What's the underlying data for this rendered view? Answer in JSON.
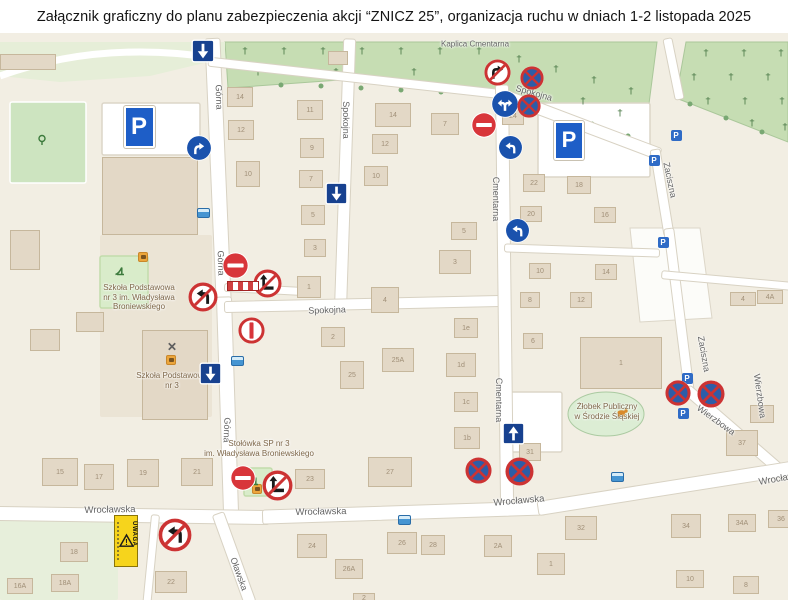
{
  "title": "Załącznik graficzny do planu zabezpieczenia akcji “ZNICZ 25”, organizacja ruchu w dniach 1-2 listopada 2025",
  "colors": {
    "sign_blue": "#1a52ad",
    "oneway_blue": "#17418f",
    "prohibit_red": "#cc3333",
    "no_entry_red": "#d8353a",
    "no_stop_blue": "#2d5da8",
    "parking_blue": "#1e5ec7",
    "uwaga_yellow": "#f6d41c",
    "bus_blue": "#4695d2",
    "cemetery_green": "#c6ddb3",
    "building_tan": "#e3d8c6"
  },
  "map": {
    "street_labels": [
      [
        "Kaplica Cmentarna",
        475,
        44,
        0,
        8
      ],
      [
        "Górna",
        219,
        97,
        88,
        9
      ],
      [
        "Górna",
        221,
        263,
        88,
        9
      ],
      [
        "Górna",
        227,
        430,
        92,
        9
      ],
      [
        "Spokojna",
        346,
        120,
        90,
        9
      ],
      [
        "Spokojna",
        327,
        310,
        -2,
        9
      ],
      [
        "Spokojna",
        534,
        93,
        16,
        9
      ],
      [
        "Cmentarna",
        496,
        199,
        90,
        9
      ],
      [
        "Cmentarna",
        499,
        400,
        90,
        9
      ],
      [
        "Zaciszna",
        670,
        180,
        78,
        9
      ],
      [
        "Zaciszna",
        704,
        354,
        80,
        9
      ],
      [
        "Wierzbowa",
        760,
        396,
        82,
        9
      ],
      [
        "Wierzbowa",
        716,
        420,
        36,
        9
      ],
      [
        "Wrocławska",
        110,
        510,
        -1,
        9.5
      ],
      [
        "Wrocławska",
        321,
        512,
        -1,
        9.5
      ],
      [
        "Wrocławska",
        519,
        501,
        -5,
        9.5
      ],
      [
        "Wrocławska",
        784,
        478,
        -10,
        9.5
      ],
      [
        "Oławska",
        239,
        574,
        70,
        9
      ]
    ],
    "poi_labels": [
      {
        "x": 139,
        "y": 283,
        "lines": [
          "Szkoła Podstawowa",
          "nr 3 im. Władysława",
          "Broniewskiego"
        ]
      },
      {
        "x": 172,
        "y": 371,
        "lines": [
          "Szkoła Podstawowa",
          "nr 3"
        ]
      },
      {
        "x": 259,
        "y": 439,
        "lines": [
          "Stołówka SP nr 3",
          "im. Władysława Broniewskiego"
        ]
      },
      {
        "x": 607,
        "y": 402,
        "lines": [
          "Żłobek Publiczny",
          "w Środzie Śląskiej"
        ]
      }
    ],
    "buildings": [
      [
        240,
        97,
        26,
        20,
        "14"
      ],
      [
        241,
        130,
        26,
        20,
        "12"
      ],
      [
        248,
        174,
        24,
        26,
        "10"
      ],
      [
        310,
        110,
        26,
        20,
        "11"
      ],
      [
        312,
        148,
        24,
        20,
        "9"
      ],
      [
        311,
        179,
        24,
        18,
        "7"
      ],
      [
        313,
        215,
        24,
        20,
        "5"
      ],
      [
        315,
        248,
        22,
        18,
        "3"
      ],
      [
        309,
        287,
        24,
        22,
        "1"
      ],
      [
        393,
        115,
        36,
        24,
        "14"
      ],
      [
        385,
        144,
        26,
        20,
        "12"
      ],
      [
        376,
        176,
        24,
        20,
        "10"
      ],
      [
        445,
        124,
        28,
        22,
        "7"
      ],
      [
        464,
        231,
        26,
        18,
        "5"
      ],
      [
        455,
        262,
        32,
        24,
        "3"
      ],
      [
        385,
        300,
        28,
        26,
        "4"
      ],
      [
        333,
        337,
        24,
        20,
        "2"
      ],
      [
        398,
        360,
        32,
        24,
        "25A"
      ],
      [
        352,
        375,
        24,
        28,
        "25"
      ],
      [
        466,
        328,
        24,
        20,
        "1e"
      ],
      [
        461,
        365,
        30,
        24,
        "1d"
      ],
      [
        466,
        402,
        24,
        20,
        "1c"
      ],
      [
        467,
        438,
        26,
        22,
        "1b"
      ],
      [
        513,
        116,
        22,
        18,
        "24"
      ],
      [
        534,
        183,
        22,
        18,
        "22"
      ],
      [
        579,
        185,
        24,
        18,
        "18"
      ],
      [
        531,
        214,
        22,
        16,
        "20"
      ],
      [
        605,
        215,
        22,
        16,
        "16"
      ],
      [
        540,
        271,
        22,
        16,
        "10"
      ],
      [
        606,
        272,
        22,
        16,
        "14"
      ],
      [
        581,
        300,
        22,
        16,
        "12"
      ],
      [
        530,
        300,
        20,
        16,
        "8"
      ],
      [
        533,
        341,
        20,
        16,
        "6"
      ],
      [
        743,
        299,
        26,
        14,
        "4"
      ],
      [
        770,
        297,
        26,
        14,
        "4A"
      ],
      [
        762,
        414,
        24,
        18,
        "7"
      ],
      [
        742,
        443,
        32,
        26,
        "37"
      ],
      [
        530,
        452,
        22,
        18,
        "31"
      ],
      [
        621,
        363,
        82,
        52,
        "1"
      ],
      [
        60,
        472,
        36,
        28,
        "15"
      ],
      [
        99,
        477,
        30,
        26,
        "17"
      ],
      [
        143,
        473,
        32,
        28,
        "19"
      ],
      [
        197,
        472,
        32,
        28,
        "21"
      ],
      [
        74,
        552,
        28,
        20,
        "18"
      ],
      [
        65,
        583,
        28,
        18,
        "18A"
      ],
      [
        20,
        586,
        26,
        16,
        "16A"
      ],
      [
        171,
        582,
        32,
        22,
        "22"
      ],
      [
        310,
        479,
        30,
        20,
        "23"
      ],
      [
        390,
        472,
        44,
        30,
        "27"
      ],
      [
        312,
        546,
        30,
        24,
        "24"
      ],
      [
        349,
        569,
        28,
        20,
        "26A"
      ],
      [
        402,
        543,
        30,
        22,
        "26"
      ],
      [
        433,
        545,
        24,
        20,
        "28"
      ],
      [
        498,
        546,
        28,
        22,
        "2A"
      ],
      [
        581,
        528,
        32,
        24,
        "32"
      ],
      [
        686,
        526,
        30,
        24,
        "34"
      ],
      [
        742,
        523,
        28,
        18,
        "34A"
      ],
      [
        781,
        519,
        26,
        18,
        "36"
      ],
      [
        551,
        564,
        28,
        22,
        "1"
      ],
      [
        690,
        579,
        28,
        18,
        "10"
      ],
      [
        746,
        585,
        26,
        18,
        "8"
      ],
      [
        364,
        598,
        22,
        10,
        "2"
      ],
      [
        150,
        196,
        96,
        78,
        ""
      ],
      [
        175,
        375,
        66,
        90,
        ""
      ],
      [
        28,
        62,
        56,
        16,
        ""
      ],
      [
        338,
        58,
        20,
        14,
        ""
      ],
      [
        90,
        322,
        28,
        20,
        ""
      ],
      [
        45,
        340,
        30,
        22,
        ""
      ],
      [
        25,
        250,
        30,
        40,
        ""
      ]
    ],
    "signs": [
      [
        "oneway-down",
        203,
        51,
        24,
        24
      ],
      [
        "oneway-down",
        336,
        193,
        23,
        23
      ],
      [
        "oneway-down",
        210,
        373,
        23,
        23
      ],
      [
        "oneway-up",
        513,
        433,
        23,
        23
      ],
      [
        "mandatory-right",
        199,
        148,
        26,
        26
      ],
      [
        "mandatory-left-right",
        505,
        104,
        28,
        28
      ],
      [
        "mandatory-left",
        510,
        147,
        25,
        25
      ],
      [
        "mandatory-left",
        517,
        230,
        25,
        25
      ],
      [
        "no-entry",
        484,
        125,
        26,
        26
      ],
      [
        "no-entry",
        235,
        265,
        27,
        27
      ],
      [
        "no-entry",
        243,
        478,
        26,
        26
      ],
      [
        "no-stopping",
        532,
        78,
        24,
        24
      ],
      [
        "no-stopping",
        529,
        106,
        24,
        24
      ],
      [
        "no-stopping",
        478,
        470,
        27,
        27
      ],
      [
        "no-stopping",
        519,
        471,
        29,
        29
      ],
      [
        "no-stopping",
        678,
        393,
        26,
        26
      ],
      [
        "no-stopping",
        711,
        394,
        28,
        28
      ],
      [
        "no-right-turn",
        497,
        72,
        27,
        27
      ],
      [
        "no-left-turn",
        203,
        297,
        30,
        30
      ],
      [
        "no-left-turn",
        175,
        535,
        34,
        34
      ],
      [
        "no-straight-turn",
        267,
        283,
        29,
        29
      ],
      [
        "no-straight-turn",
        277,
        485,
        31,
        31
      ],
      [
        "no-entry-vertical",
        251,
        330,
        27,
        27
      ],
      [
        "road-barrier",
        243,
        286,
        32,
        10
      ],
      [
        "uwaga-board",
        126,
        541,
        24,
        52
      ],
      [
        "parking-large",
        139,
        127,
        31,
        38
      ],
      [
        "parking-large",
        569,
        140,
        30,
        35
      ]
    ],
    "icons": [
      [
        "parking-small",
        676,
        135
      ],
      [
        "parking-small",
        654,
        160
      ],
      [
        "parking-small",
        663,
        242
      ],
      [
        "parking-small",
        687,
        378
      ],
      [
        "parking-small",
        683,
        413
      ],
      [
        "bus-stop",
        203,
        213
      ],
      [
        "bus-stop",
        237,
        361
      ],
      [
        "bus-stop",
        404,
        520
      ],
      [
        "bus-stop",
        617,
        477
      ],
      [
        "restaurant",
        172,
        346
      ],
      [
        "shop",
        143,
        257
      ],
      [
        "shop",
        171,
        360
      ],
      [
        "shop",
        257,
        489
      ],
      [
        "playground",
        119,
        270
      ],
      [
        "playground",
        253,
        480
      ],
      [
        "sports",
        42,
        140
      ],
      [
        "pet",
        622,
        412
      ]
    ]
  }
}
